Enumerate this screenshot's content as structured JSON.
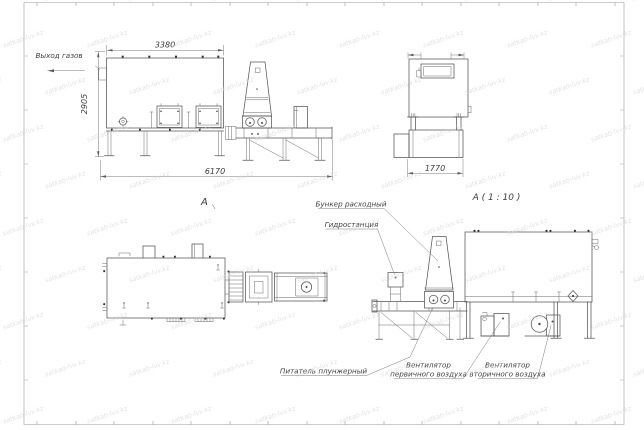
{
  "colors": {
    "background": "#ffffff",
    "line": "#565656",
    "dimension": "#787878",
    "text": "#3d3d3d",
    "watermark": "#d6d6d6"
  },
  "watermark": {
    "text": "satkab-lvv.kz"
  },
  "front_view": {
    "callout_gas_outlet": "Выход газов",
    "dim_width_top": "3380",
    "dim_height": "2905",
    "dim_width_total": "6170",
    "label": "А"
  },
  "end_view": {
    "dim_width": "1770",
    "label": "А ( 1 : 10 )"
  },
  "side_view": {
    "callout_hopper": "Бункер расходный",
    "callout_hydraulic": "Гидростанция",
    "callout_feeder": "Питатель плунжерный",
    "callout_fan_primary": [
      "Вентилятор",
      "первичного воздуха"
    ],
    "callout_fan_secondary": [
      "Вентилятор",
      "вторичного воздуха"
    ]
  }
}
